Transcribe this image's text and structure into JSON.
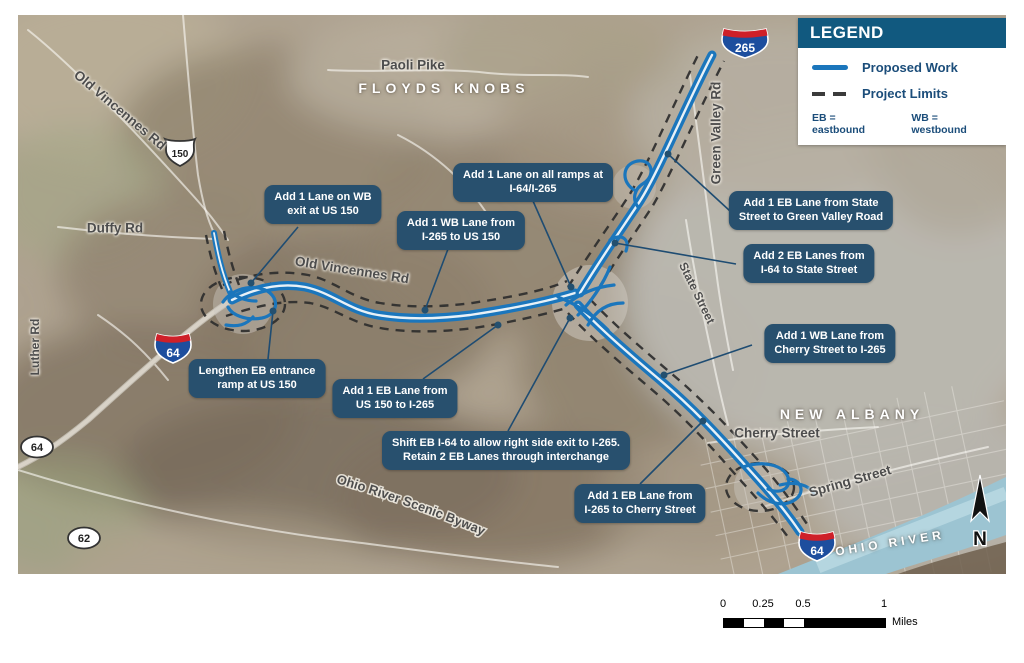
{
  "legend": {
    "title": "LEGEND",
    "items": [
      {
        "label": "Proposed Work",
        "swatch": "solid-blue-line",
        "color": "#1b76bc"
      },
      {
        "label": "Project Limits",
        "swatch": "dashed-black-line",
        "color": "#3b3b3b"
      }
    ],
    "abbreviations": {
      "eb": "EB = eastbound",
      "wb": "WB = westbound"
    }
  },
  "callouts": [
    {
      "id": "wb-exit-us150",
      "lines": [
        "Add 1 Lane on WB",
        "exit at US 150"
      ]
    },
    {
      "id": "wb-lane-i265-us150",
      "lines": [
        "Add 1 WB Lane from",
        "I-265 to US 150"
      ]
    },
    {
      "id": "all-ramps-i64-i265",
      "lines": [
        "Add 1 Lane on all ramps at",
        "I-64/I-265"
      ]
    },
    {
      "id": "eb-state-greenvalley",
      "lines": [
        "Add 1 EB Lane from State",
        "Street to Green Valley Road"
      ]
    },
    {
      "id": "eb-i64-state",
      "lines": [
        "Add 2 EB Lanes from",
        "I-64 to State Street"
      ]
    },
    {
      "id": "wb-cherry-i265",
      "lines": [
        "Add 1 WB Lane from",
        "Cherry Street to I-265"
      ]
    },
    {
      "id": "lengthen-eb-ramp",
      "lines": [
        "Lengthen EB entrance",
        "ramp at US 150"
      ]
    },
    {
      "id": "eb-us150-i265",
      "lines": [
        "Add 1 EB Lane from",
        "US 150 to I-265"
      ]
    },
    {
      "id": "shift-eb-i64",
      "lines": [
        "Shift EB I-64 to allow right side exit to I-265.",
        "Retain 2 EB Lanes through interchange"
      ]
    },
    {
      "id": "eb-i265-cherry",
      "lines": [
        "Add 1 EB Lane from",
        "I-265 to Cherry Street"
      ]
    }
  ],
  "map_labels": {
    "roads": {
      "old_vincennes": "Old Vincennes Rd",
      "paoli_pike": "Paoli Pike",
      "duffy_rd": "Duffy Rd",
      "luther_rd": "Luther Rd",
      "green_valley_rd": "Green Valley Rd",
      "state_street": "State Street",
      "cherry_street": "Cherry Street",
      "spring_street": "Spring Street",
      "scenic_byway": "Ohio River Scenic Byway"
    },
    "places": {
      "floyds_knobs": "FLOYDS KNOBS",
      "new_albany": "NEW ALBANY",
      "ohio_river": "OHIO RIVER"
    }
  },
  "shields": {
    "us150": "150",
    "i64_west": "64",
    "i64_southeast": "64",
    "i265": "265",
    "state_64": "64",
    "state_62": "62"
  },
  "scale_bar": {
    "ticks": [
      "0",
      "0.25",
      "0.5",
      "1"
    ],
    "unit": "Miles"
  },
  "north_arrow": {
    "label": "N"
  },
  "colors": {
    "proposed_work": "#1b76bc",
    "project_limits": "#3b3b3b",
    "callout_bg": "#28506e",
    "legend_header_bg": "#11597f",
    "legend_text": "#1b4d7a",
    "river": "#9cc4d2"
  }
}
